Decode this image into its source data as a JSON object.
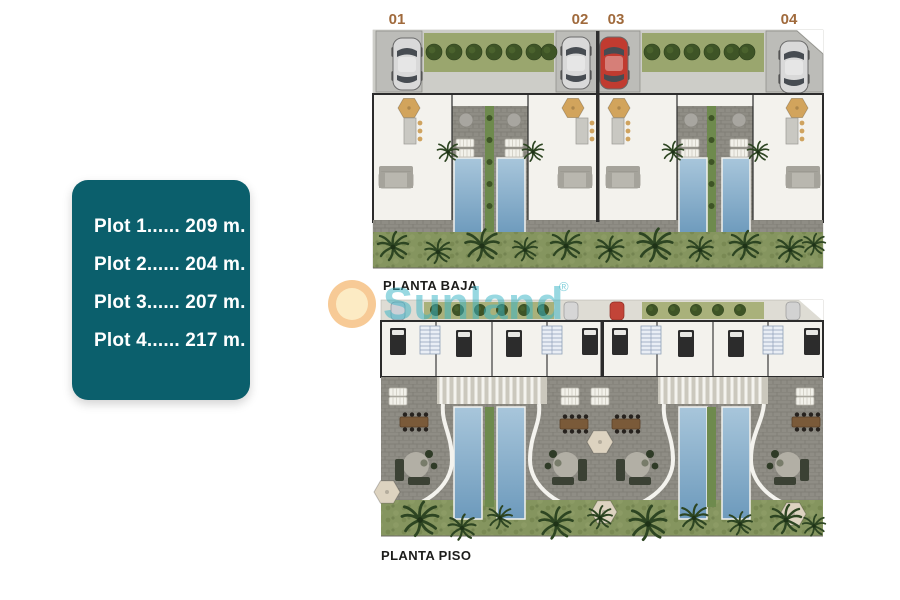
{
  "page": {
    "background_color": "#ffffff"
  },
  "plots_box": {
    "background_color": "#0b5f6c",
    "text_color": "#ffffff",
    "items": [
      "Plot 1...... 209 m.",
      "Plot 2...... 204 m.",
      "Plot 3...... 207 m.",
      "Plot 4...... 217 m."
    ]
  },
  "plans": {
    "baja": {
      "title": "PLANTA BAJA",
      "unit_labels": [
        "01",
        "02",
        "03",
        "04"
      ],
      "unit_label_color": "#a06a3c"
    },
    "piso": {
      "title": "PLANTA PISO"
    }
  },
  "watermark": {
    "brand": "Sunland",
    "registered_mark": "®",
    "text_color": "#3ab5c6",
    "circle_color": "#ef974c"
  },
  "colors": {
    "terrace_pavers": "#8f8d85",
    "pool_blue": "#7da6c4",
    "garden_green": "#85955f",
    "hedge_green": "#3e5426",
    "interior_floor": "#f3f2ed",
    "wall": "#2b2b2b",
    "driveway_gray": "#bcbcb8",
    "car_red": "#c13b30",
    "car_silver": "#d9d9d9"
  }
}
